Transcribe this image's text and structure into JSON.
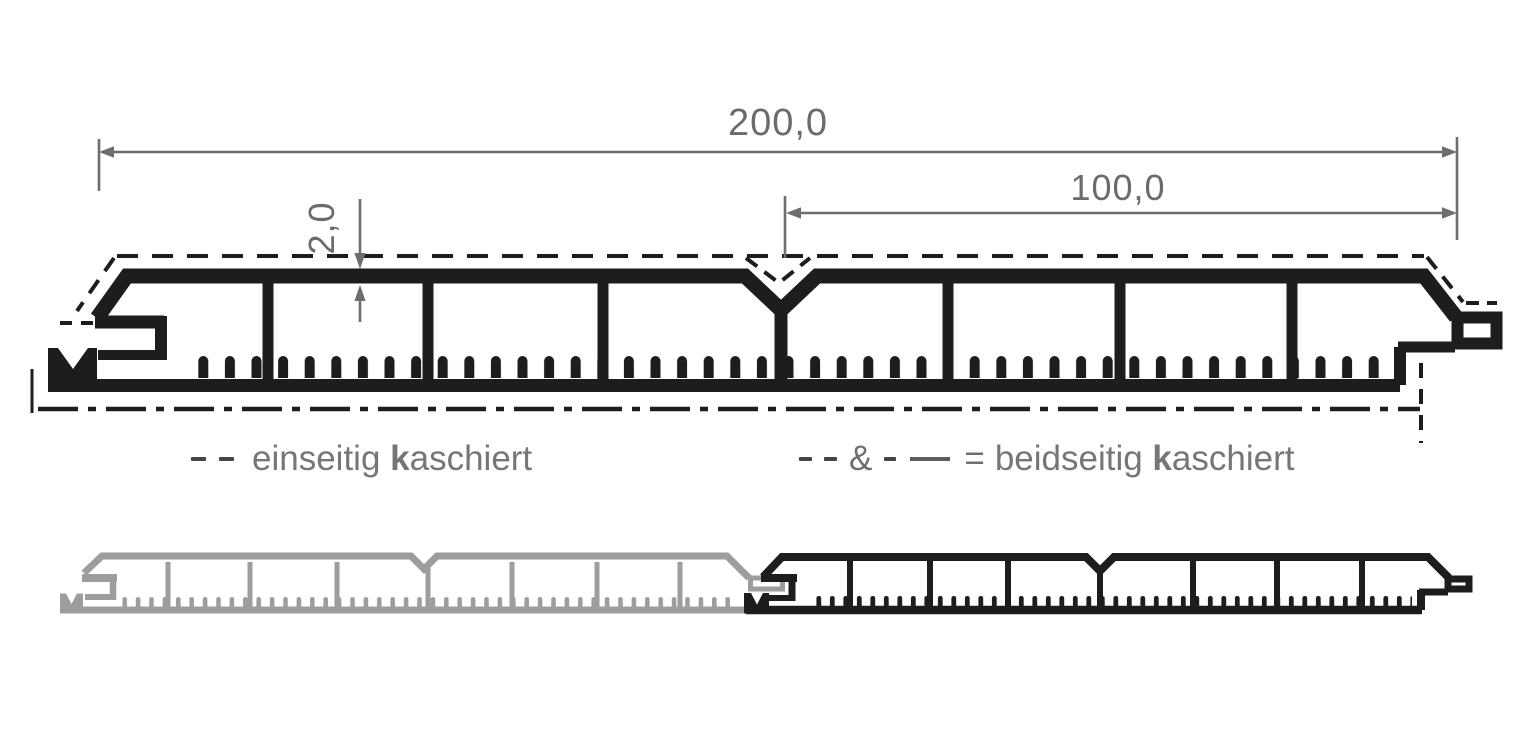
{
  "drawing": {
    "type": "profile-cross-section-technical-drawing",
    "dimensions": {
      "total_width_label": "200,0",
      "right_half_width_label": "100,0",
      "wall_thickness_label": "2,0"
    },
    "legend": {
      "left": {
        "symbol": "dashed-line",
        "label_prefix": "einseitig ",
        "label_bold_letter": "k",
        "label_suffix": "aschiert"
      },
      "right": {
        "symbol": "dashed-line & dash-dot-line",
        "ampersand": "&",
        "equals": "=",
        "label_prefix": "beidseitig ",
        "label_bold_letter": "k",
        "label_suffix": "aschiert"
      }
    },
    "colors": {
      "profile_black": "#1d1d1b",
      "profile_gray": "#9d9d9c",
      "dimension_gray": "#6d6d6d",
      "legend_text_gray": "#767676",
      "background": "#ffffff"
    }
  }
}
